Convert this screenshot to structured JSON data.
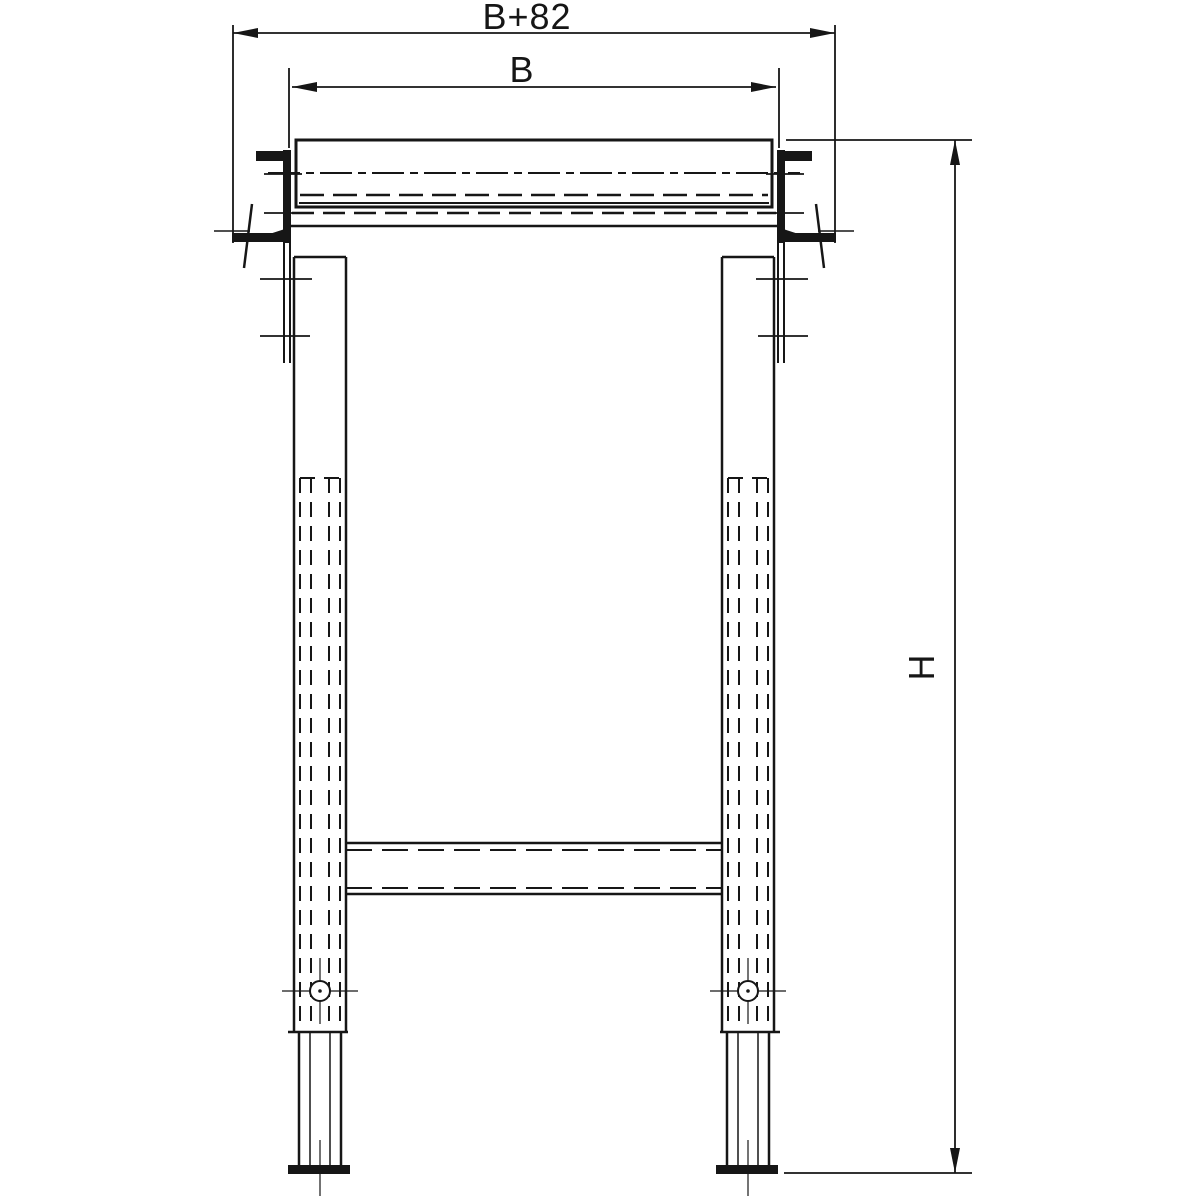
{
  "labels": {
    "outer_width": "B+82",
    "inner_width": "B",
    "height": "H"
  },
  "colors": {
    "ink": "#161616",
    "paper": "#ffffff"
  }
}
